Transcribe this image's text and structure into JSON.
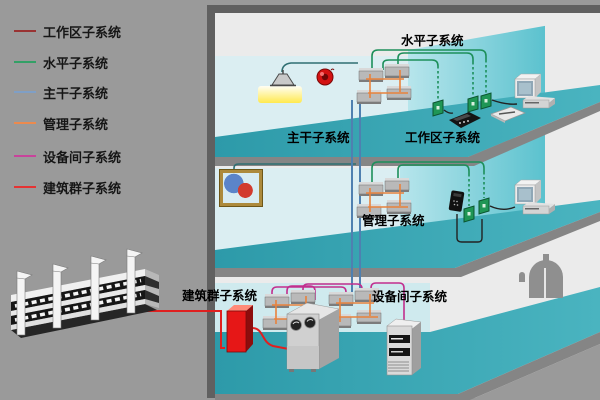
{
  "legend": {
    "items": [
      {
        "label": "工作区子系统",
        "color": "#993333"
      },
      {
        "label": "水平子系统",
        "color": "#33a066"
      },
      {
        "label": "主干子系统",
        "color": "#7f9fc6"
      },
      {
        "label": "管理子系统",
        "color": "#ec8a4e"
      },
      {
        "label": "设备间子系统",
        "color": "#c8439b"
      },
      {
        "label": "建筑群子系统",
        "color": "#e53333"
      }
    ]
  },
  "diagram": {
    "labels": {
      "horizontal_subsystem": "水平子系统",
      "backbone_subsystem": "主干子系统",
      "work_area_subsystem": "工作区子系统",
      "management_subsystem": "管理子系统",
      "equipment_room_subsystem": "设备间子系统",
      "campus_subsystem": "建筑群子系统"
    },
    "colors": {
      "floor_teal": "#34a4b1",
      "wall_cyan": "#dbeef2",
      "partition_cyan": "#55c0cd",
      "cable_green": "#1d8f5a",
      "cable_dark_teal": "#2f6f72",
      "cable_blue": "#4f80b0",
      "cable_orange": "#e8823c",
      "cable_magenta": "#c22e8e",
      "cable_red": "#e02020",
      "frame_gray": "#606060"
    }
  }
}
